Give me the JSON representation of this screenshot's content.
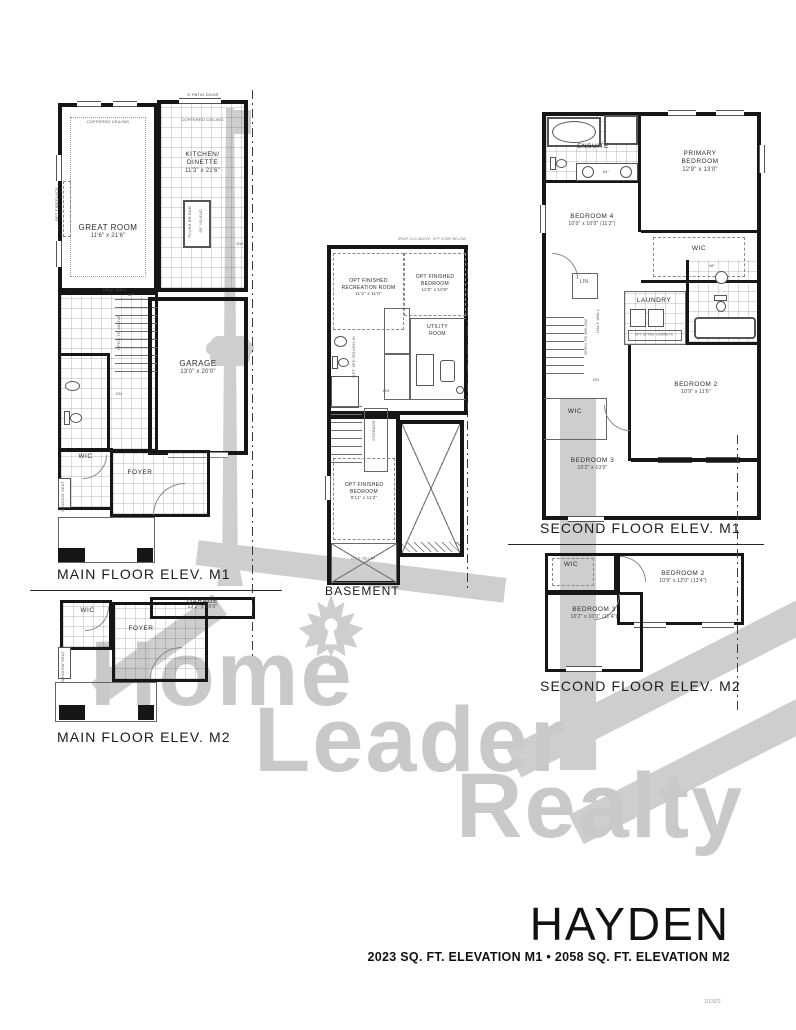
{
  "page": {
    "title": "HAYDEN",
    "subtitle": "2023 SQ. FT. ELEVATION M1 • 2058 SQ. FT. ELEVATION M2",
    "stamp": "1/13/22"
  },
  "watermark": {
    "word1": "Home",
    "word2": "Leader",
    "word3": "Realty",
    "color": "#c9c9c9"
  },
  "captions": {
    "main_m1": "MAIN FLOOR ELEV. M1",
    "main_m2": "MAIN FLOOR ELEV. M2",
    "basement": "BASEMENT",
    "second_m1": "SECOND FLOOR ELEV. M1",
    "second_m2": "SECOND FLOOR ELEV. M2"
  },
  "main_m1": {
    "patio_door": "6' PATIO DOOR",
    "coffered_great": "COFFERED CEILING",
    "coffered_kitchen": "COFFERED CEILING",
    "great_room": {
      "name": "GREAT ROOM",
      "dim": "11'6\" x 21'6\""
    },
    "kitchen": {
      "line1": "KITCHEN/",
      "line2": "DINETTE",
      "dim": "11'3\" x 21'6\""
    },
    "island_line1": "FLUSH BR BAR",
    "island_line2": "60\" ISLAND",
    "dw": "DW",
    "opt_fireplace": "OPT FIREPLACE",
    "half_wall": "HALF WALL",
    "up": "UP",
    "dn": "DN",
    "open_to_above": "OPEN TO ABOVE",
    "garage": {
      "name": "GARAGE",
      "dim": "13'0\" x 20'0\""
    },
    "wic": "WIC",
    "foyer": "FOYER",
    "window_seat": "WINDOW SEAT"
  },
  "main_m2": {
    "garage": {
      "name": "GARAGE",
      "dim": "13'2\" x 20'0\""
    },
    "wic": "WIC",
    "foyer": "FOYER",
    "window_seat": "WINDOW SEAT"
  },
  "basement": {
    "top_note": "DROP CLG ABOVE, OPT STAIR BELOW",
    "rec_room": {
      "line1": "OPT FINISHED",
      "line2": "RECREATION ROOM",
      "dim": "11'2\" x 11'0\""
    },
    "opt_bedroom": {
      "line1": "OPT FINISHED",
      "line2": "BEDROOM",
      "dim": "11'0\" x 10'6\""
    },
    "utility": {
      "line1": "UTILITY",
      "line2": "ROOM"
    },
    "rough_in": "OPT 3PC ROUGH-IN",
    "lin": "LIN",
    "storage": "STORAGE",
    "lower_bedroom": {
      "line1": "OPT FINISHED",
      "line2": "BEDROOM",
      "dim": "9'11\" x 11'2\""
    },
    "cold_cellar": "COLD CELLAR"
  },
  "second_m1": {
    "ensuite": "ENSUITE",
    "vanity_84": "84\"",
    "vanity_48": "48\"",
    "primary": {
      "line1": "PRIMARY",
      "line2": "BEDROOM",
      "dim": "12'9\" x 13'0\""
    },
    "bedroom4": {
      "name": "BEDROOM 4",
      "dim": "10'0\" x 10'0\" (11'2\")"
    },
    "wic_primary": "WIC",
    "lin": "LIN",
    "laundry": "LAUNDRY",
    "opt_cabinets": "OPT UPPER CABINETS",
    "open_to_below": "OPEN TO BELOW",
    "half_wall": "HALF WALL",
    "dn": "DN",
    "bedroom2": {
      "name": "BEDROOM 2",
      "dim": "10'9\" x 11'6\""
    },
    "wic2": "WIC",
    "bedroom3": {
      "name": "BEDROOM 3",
      "dim": "10'2\" x 10'0\""
    }
  },
  "second_m2": {
    "wic": "WIC",
    "bedroom2": {
      "name": "BEDROOM 2",
      "dim": "10'9\" x 12'0\" (13'4\")"
    },
    "bedroom3": {
      "name": "BEDROOM 3",
      "dim": "10'2\" x 10'0\" (11'4\")"
    }
  }
}
